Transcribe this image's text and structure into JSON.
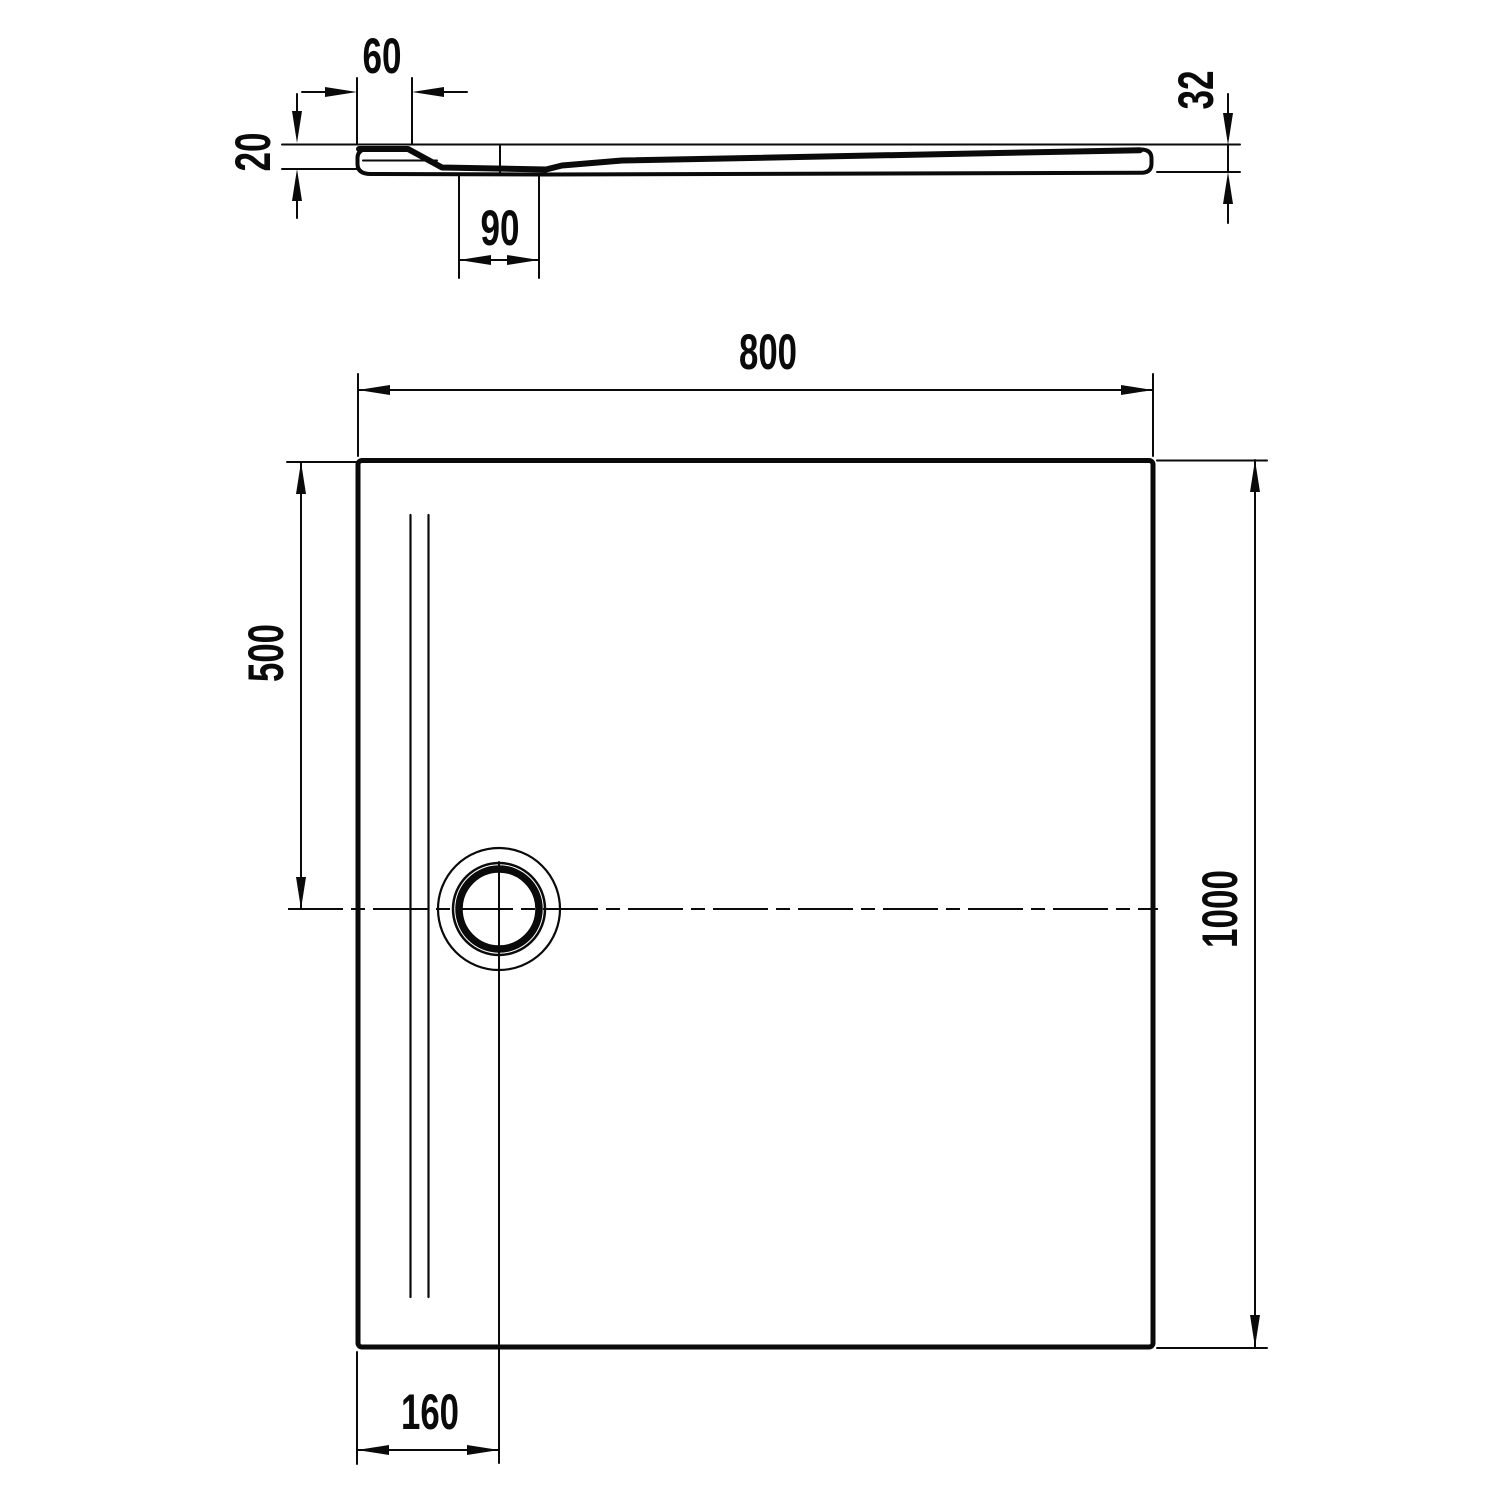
{
  "drawing": {
    "background": "#ffffff",
    "line_color": "#0a0a0a",
    "section_view": {
      "rim_width": "60",
      "edge_thickness": "20",
      "channel_width": "90",
      "end_thickness": "32"
    },
    "plan_view": {
      "width": "800",
      "drain_center_from_top": "500",
      "length": "1000",
      "drain_center_from_left": "160"
    }
  }
}
